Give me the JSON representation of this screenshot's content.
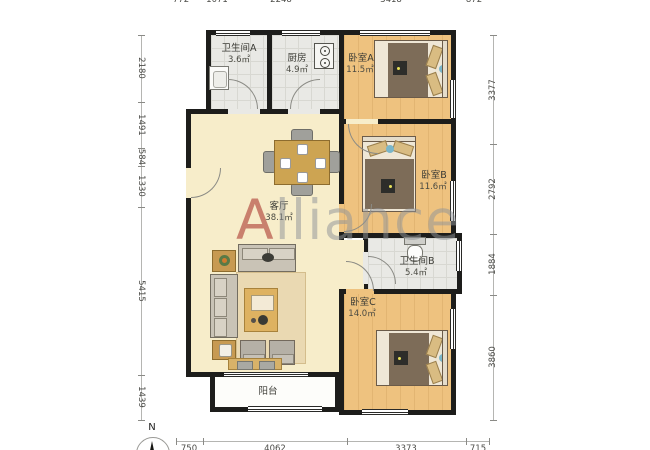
{
  "plan": {
    "watermark": "Alliance",
    "compass_label": "N",
    "rooms": {
      "bathroom_a": {
        "name": "卫生间A",
        "area": "3.6㎡"
      },
      "kitchen": {
        "name": "厨房",
        "area": "4.9㎡"
      },
      "bedroom_a": {
        "name": "卧室A",
        "area": "11.5㎡"
      },
      "bedroom_b": {
        "name": "卧室B",
        "area": "11.6㎡"
      },
      "bathroom_b": {
        "name": "卫生间B",
        "area": "5.4㎡"
      },
      "bedroom_c": {
        "name": "卧室C",
        "area": "14.0㎡"
      },
      "living": {
        "name": "客厅",
        "area": "38.1㎡"
      },
      "balcony": {
        "name": "阳台"
      }
    },
    "dimensions": {
      "top": [
        "772",
        "1071",
        "2248",
        "3418",
        "872"
      ],
      "bottom": [
        "750",
        "4062",
        "3373",
        "715"
      ],
      "left": [
        "2180",
        "1491",
        "584",
        "1330",
        "5415",
        "1439"
      ],
      "right": [
        "3377",
        "2792",
        "1884",
        "3860"
      ]
    },
    "colors": {
      "wall": "#1d1d1b",
      "living_floor": "#f7edca",
      "wood_floor": "#eec27f",
      "tile_floor": "#e9e9e5",
      "balcony_floor": "#fdfdfa",
      "watermark_gray": "#8f9498",
      "watermark_red": "#ac3e34"
    }
  }
}
